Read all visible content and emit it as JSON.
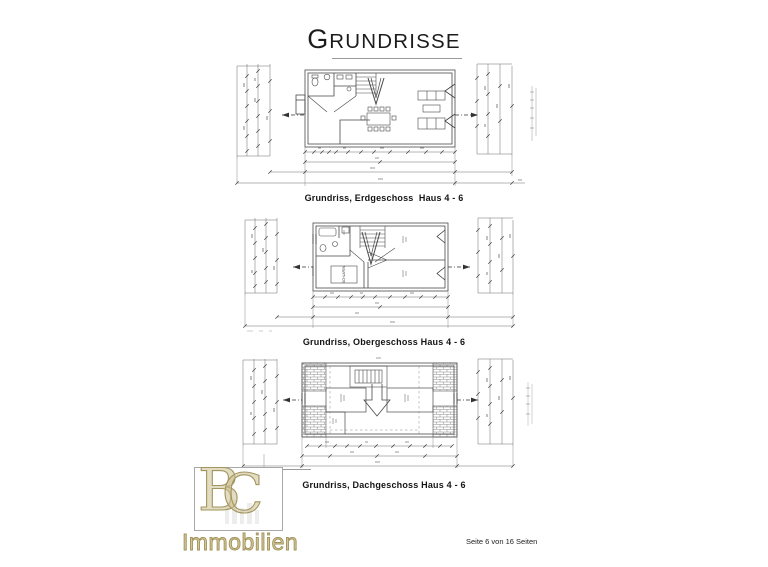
{
  "page": {
    "title": {
      "initial": "G",
      "rest": "RUNDRISSE"
    },
    "footer_text": "Seite 6 von 16 Seiten"
  },
  "plans": {
    "erdgeschoss": {
      "caption": "Grundriss, Erdgeschoss  Haus 4 - 6"
    },
    "obergeschoss": {
      "caption": "Grundriss, Obergeschoss Haus 4 - 6",
      "bedroom_label": "SCHLAFEN"
    },
    "dachgeschoss": {
      "caption": "Grundriss, Dachgeschoss Haus 4 - 6"
    }
  },
  "logo": {
    "letter_b": "B",
    "letter_c": "C",
    "name": "Immobilien"
  },
  "colors": {
    "drawing_line": "#4a4a4a",
    "dimension_line": "#6a6a6a",
    "logo_gold": "#a3955e",
    "logo_fill": "#d2c696"
  }
}
